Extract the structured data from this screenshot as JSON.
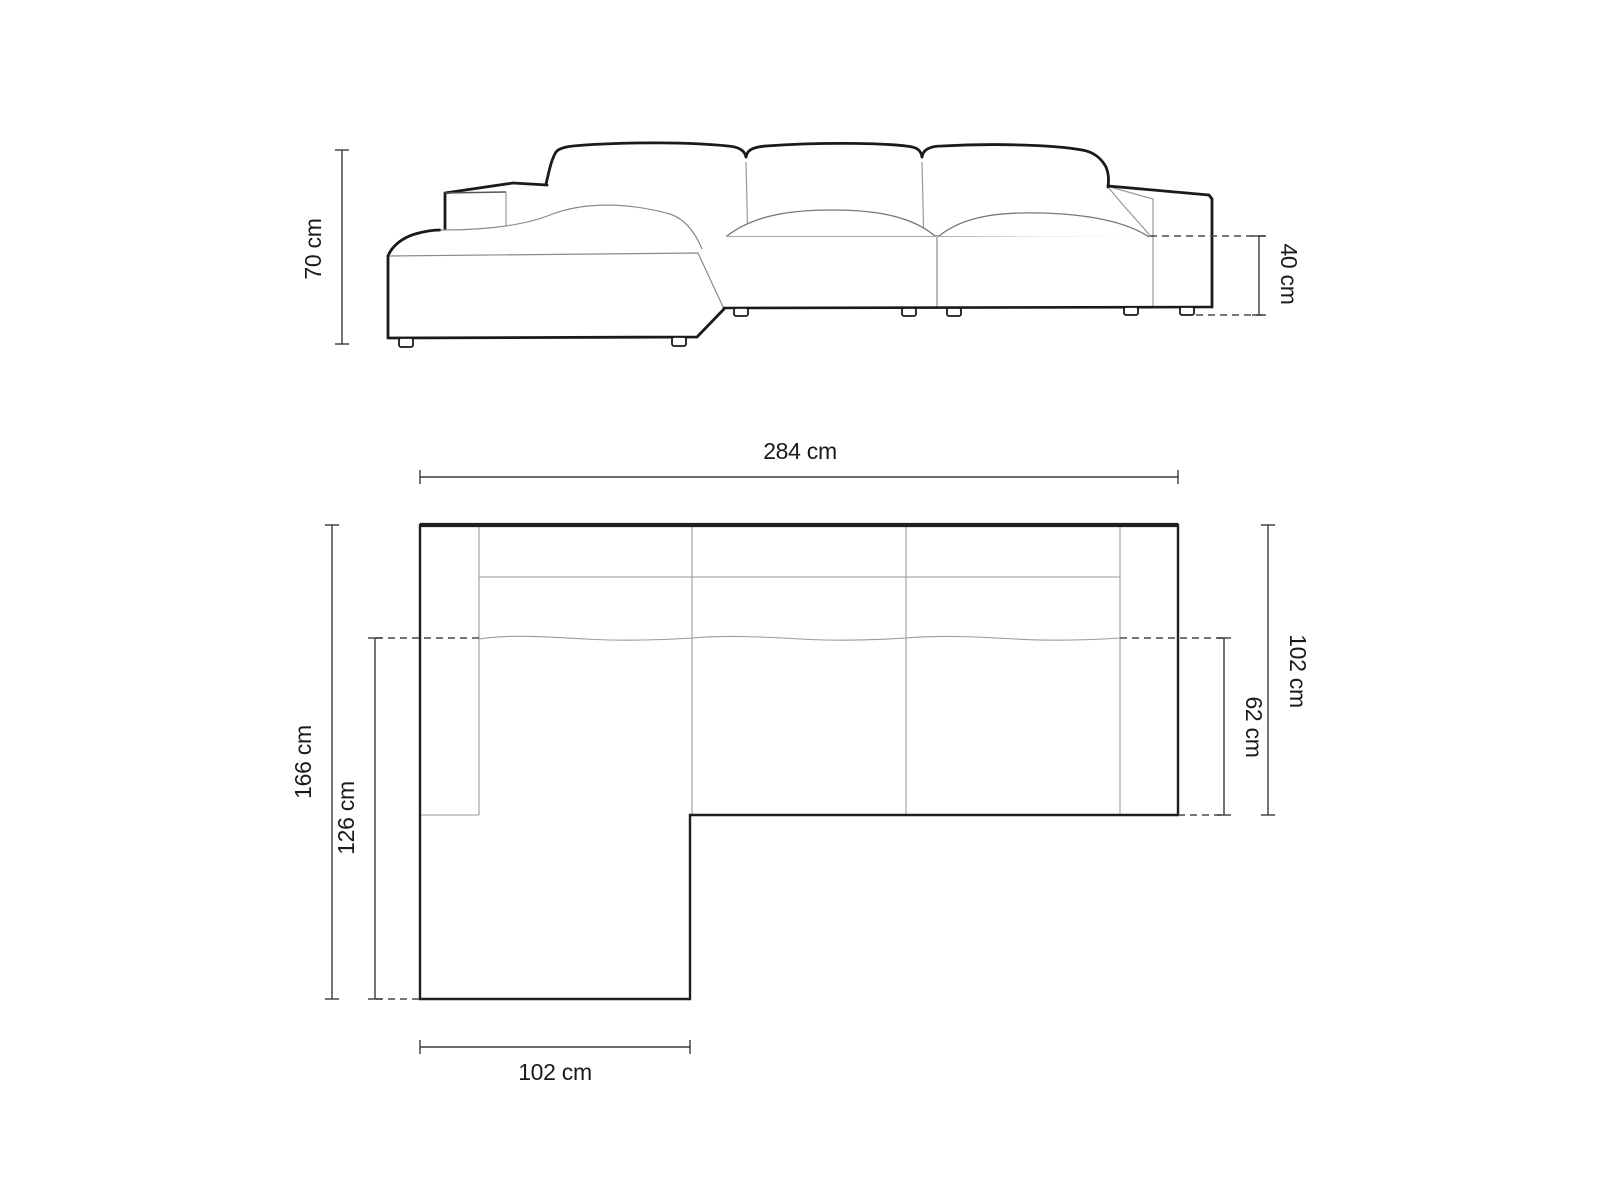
{
  "title": "Corner sofa dimensions diagram",
  "colors": {
    "background": "#ffffff",
    "silhouette": "#1a1a1a",
    "interior_line": "#999999",
    "interior_dark": "#666666",
    "dimension_line": "#3a3a3a",
    "dashed_line": "#4a4a4a",
    "text": "#1a1a1a"
  },
  "front_view": {
    "name": "front-elevation",
    "dims": {
      "total_height": "70 cm",
      "seat_height": "40 cm"
    }
  },
  "top_view": {
    "name": "top-plan",
    "dims": {
      "total_width": "284 cm",
      "total_depth": "166 cm",
      "chaise_depth": "126 cm",
      "body_depth": "102 cm",
      "seat_depth": "62 cm",
      "chaise_width": "102 cm"
    }
  }
}
